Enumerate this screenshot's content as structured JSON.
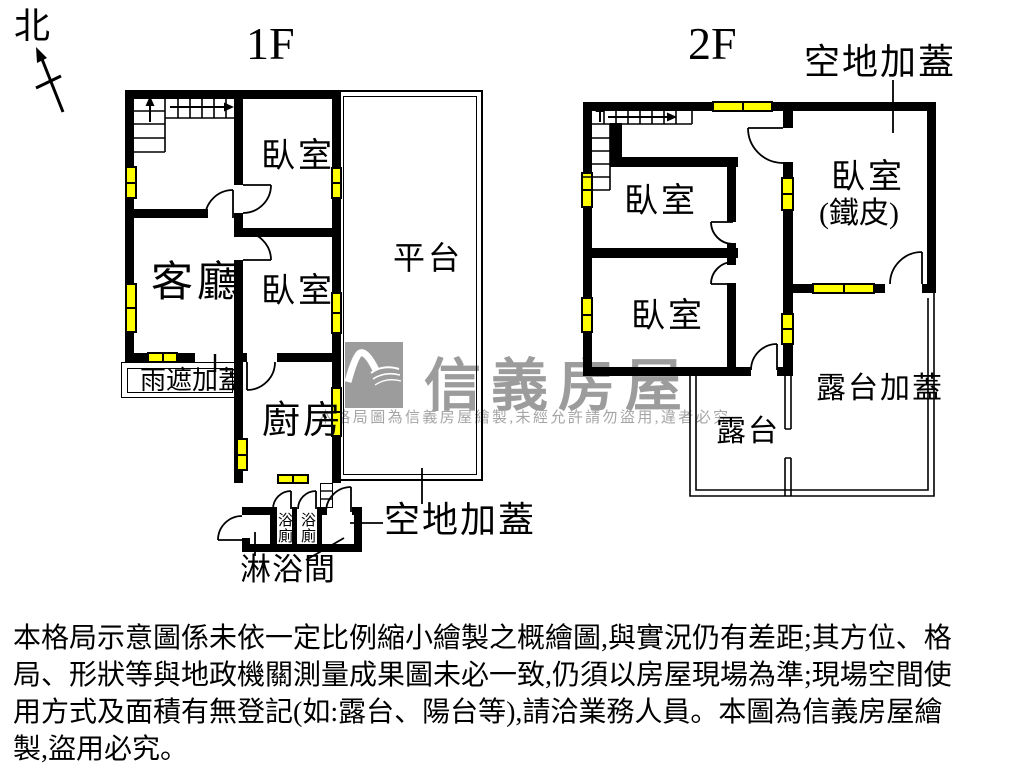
{
  "north": {
    "label": "北"
  },
  "floor1": {
    "title": "1F",
    "rooms": {
      "bedroom_top": "臥室",
      "living": "客廳",
      "bedroom_mid": "臥室",
      "platform": "平台",
      "rain_cover": "雨遮加蓋",
      "kitchen": "廚房",
      "bath_left": "浴廁",
      "bath_right": "浴廁",
      "shower": "淋浴間",
      "open_addition": "空地加蓋"
    }
  },
  "floor2": {
    "title": "2F",
    "rooms": {
      "bedroom_a": "臥室",
      "bedroom_b": "臥室",
      "bedroom_tin_line1": "臥室",
      "bedroom_tin_line2": "(鐵皮)",
      "terrace": "露台",
      "terrace_cover": "露台加蓋",
      "open_addition": "空地加蓋"
    }
  },
  "watermark": {
    "brand": "信義房屋",
    "notice": "本格局圖為信義房屋繪製,未經允許請勿盜用,違者必究"
  },
  "disclaimer": {
    "lines": [
      "本格局示意圖係未依一定比例縮小繪製之概繪圖,與實況仍有差距;其方位、格",
      "局、形狀等與地政機關測量成果圖未必一致,仍須以房屋現場為準;現場空間使",
      "用方式及面積有無登記(如:露台、陽台等),請洽業務人員。本圖為信義房屋繪",
      "製,盜用必究。"
    ]
  },
  "colors": {
    "wall": "#000000",
    "window": "#ffff00",
    "watermark": "#9c9c9c"
  }
}
